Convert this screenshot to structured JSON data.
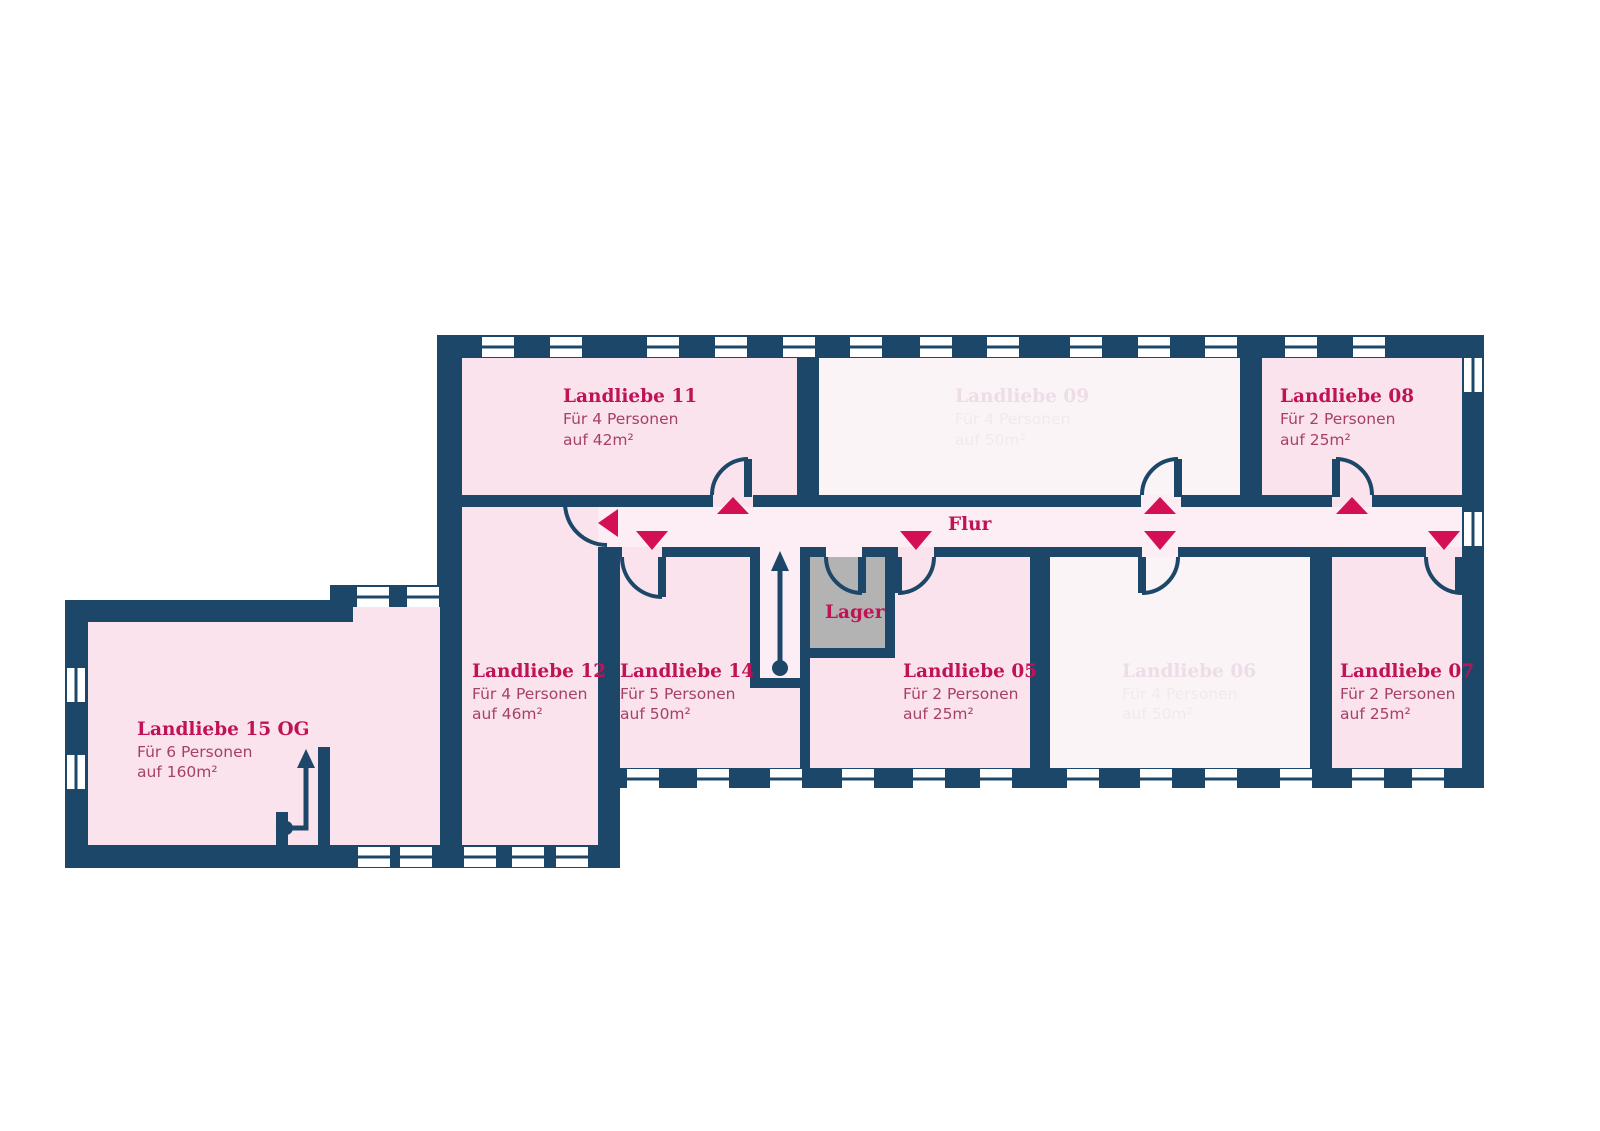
{
  "title": "Landliebe Obergeschoss Grundriss",
  "palette": {
    "wall_navy": "#1d4768",
    "room_available_pink": "#fbe3ed",
    "room_unavailable_light": "#faf4f7",
    "corridor_pink": "#fdedf4",
    "storage_gray": "#b4b3b4",
    "accent_crimson": "#c01355",
    "door_arrow_crimson": "#d40f56",
    "body_text_mauve": "#a64069",
    "unavailable_title_text": "#eedde7",
    "unavailable_body_text": "#f3e8ee"
  },
  "rooms": [
    {
      "id": "landliebe-11",
      "name": "Landliebe 11",
      "capacity": "Für 4 Personen",
      "area": "auf 42m²",
      "available": true
    },
    {
      "id": "landliebe-09",
      "name": "Landliebe 09",
      "capacity": "Für 4 Personen",
      "area": "auf 50m²",
      "available": false
    },
    {
      "id": "landliebe-08",
      "name": "Landliebe 08",
      "capacity": "Für 2 Personen",
      "area": "auf 25m²",
      "available": true
    },
    {
      "id": "landliebe-12",
      "name": "Landliebe 12",
      "capacity": "Für 4 Personen",
      "area": "auf 46m²",
      "available": true
    },
    {
      "id": "landliebe-14",
      "name": "Landliebe 14",
      "capacity": "Für 5 Personen",
      "area": "auf 50m²",
      "available": true
    },
    {
      "id": "landliebe-05",
      "name": "Landliebe 05",
      "capacity": "Für 2 Personen",
      "area": "auf 25m²",
      "available": true
    },
    {
      "id": "landliebe-06",
      "name": "Landliebe 06",
      "capacity": "Für 4 Personen",
      "area": "auf 50m²",
      "available": false
    },
    {
      "id": "landliebe-07",
      "name": "Landliebe 07",
      "capacity": "Für 2 Personen",
      "area": "auf 25m²",
      "available": true
    },
    {
      "id": "landliebe-15",
      "name": "Landliebe 15 OG",
      "capacity": "Für 6 Personen",
      "area": "auf 160m²",
      "available": true
    }
  ],
  "labels": {
    "corridor": "Flur",
    "storage": "Lager"
  }
}
